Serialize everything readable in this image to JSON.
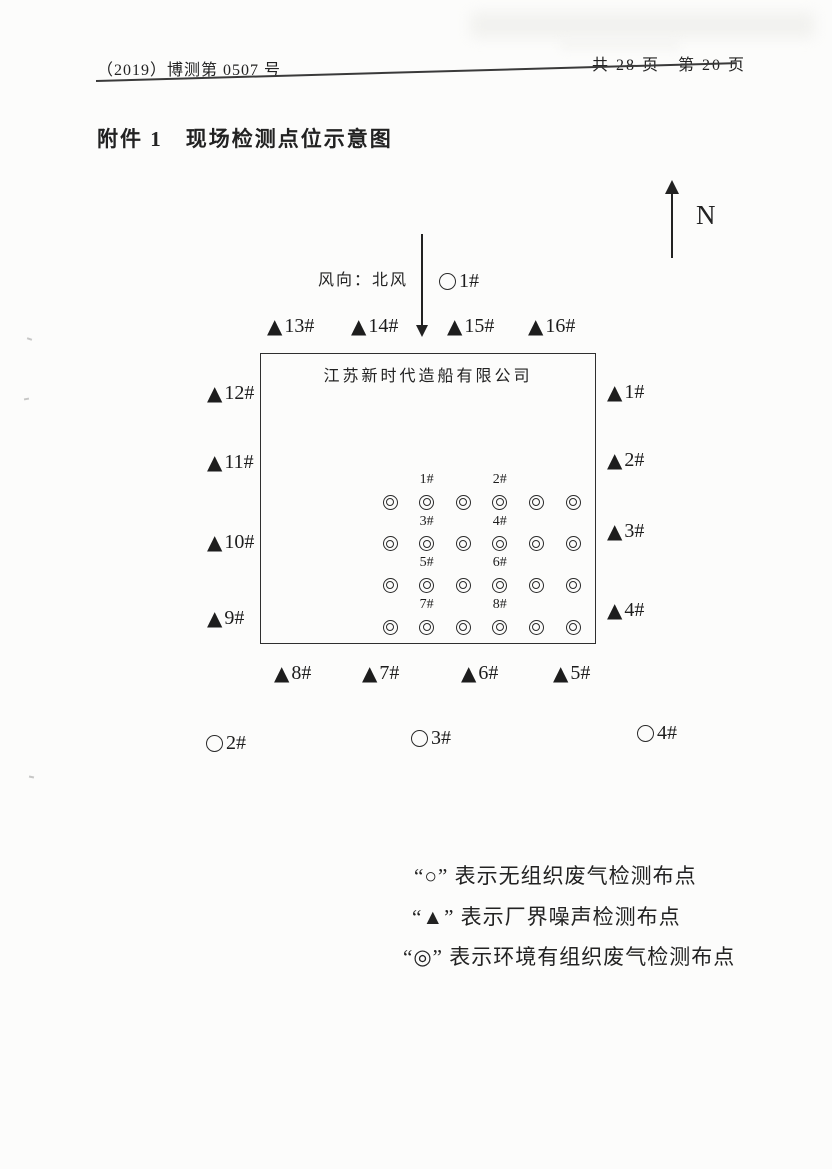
{
  "header": {
    "doc_number": "（2019）博测第 0507 号",
    "page_indicator": "共 28 页　第 20 页"
  },
  "title": "附件 1　现场检测点位示意图",
  "compass": {
    "north_label": "N"
  },
  "wind": {
    "label": "风向：北风"
  },
  "diagram": {
    "company_name": "江苏新时代造船有限公司",
    "unorganized_points": [
      {
        "label": "1#"
      },
      {
        "label": "2#"
      },
      {
        "label": "3#"
      },
      {
        "label": "4#"
      }
    ],
    "boundary_points": {
      "top": [
        "13#",
        "14#",
        "15#",
        "16#"
      ],
      "left": [
        "12#",
        "11#",
        "10#",
        "9#"
      ],
      "right": [
        "1#",
        "2#",
        "3#",
        "4#"
      ],
      "bottom": [
        "8#",
        "7#",
        "6#",
        "5#"
      ]
    },
    "stack_grid": {
      "rows": 4,
      "cols": 6,
      "labeled_cols": [
        1,
        3
      ],
      "labels": [
        "1#",
        "2#",
        "3#",
        "4#",
        "5#",
        "6#",
        "7#",
        "8#"
      ]
    }
  },
  "legend": {
    "items": [
      {
        "text": "“○” 表示无组织废气检测布点"
      },
      {
        "text": "“▲” 表示厂界噪声检测布点"
      },
      {
        "text": "“◎” 表示环境有组织废气检测布点"
      }
    ]
  },
  "icons": {
    "triangle": "▲"
  },
  "colors": {
    "ink": "#222222",
    "paper": "#fcfcfb"
  }
}
